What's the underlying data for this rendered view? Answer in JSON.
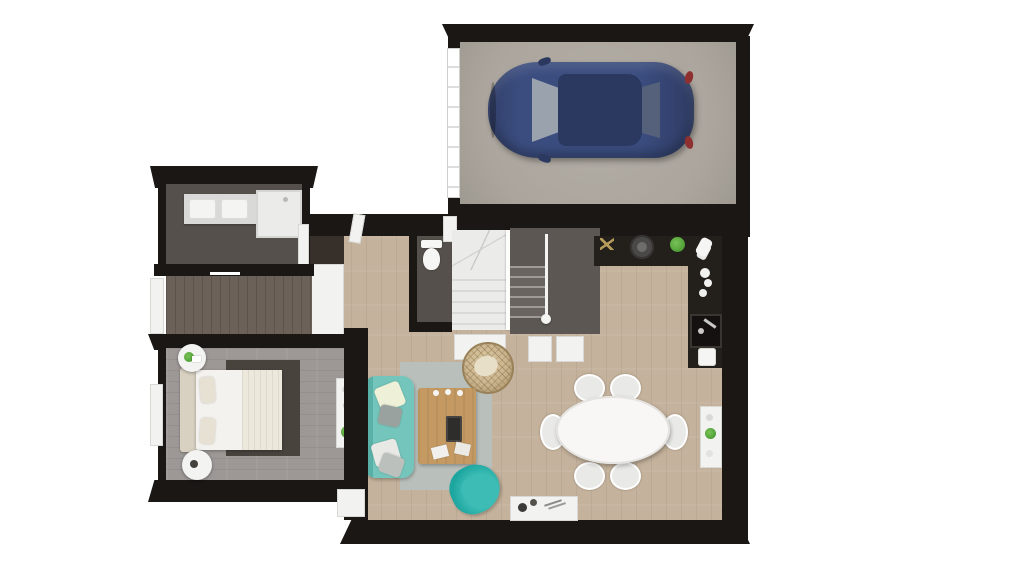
{
  "scene": {
    "type": "3d-floor-plan-top-down",
    "description": "Top-down 3D rendered floor plan of a single-storey home with attached garage, shown on a white background. No text labels are visible in the image."
  },
  "colors": {
    "background": "#ffffff",
    "wall": "#1a1715",
    "garage_floor": "#aba59d",
    "main_floor": "#c4b29c",
    "bedroom_floor": "#9d9896",
    "corridor_floor": "#6b6159",
    "bathroom_floor": "#55504b",
    "dark_zone": "#5c5752",
    "closet_dark": "#362f2a",
    "white_panel": "#f2f2f0",
    "stairs_light": "#ebebe9",
    "stairs_step": "#d9d9d7",
    "counter_dark": "#23201c",
    "sink_dark": "#141110",
    "rug_base": "#b9c0bc",
    "rug_dark": "#17545e",
    "rug_teal": "#2e8b8a",
    "bedroom_rug": "#49433e",
    "bed_white": "#f3f2ef",
    "headboard": "#d8d1c1",
    "pillow": "#e7e1d3",
    "sofa": "#74c6bc",
    "sofa_shade": "#58b0a6",
    "armchair": "#1ca69f",
    "armchair_light": "#3cbcb4",
    "coffee_table": "#c49a62",
    "hanging_chair": "#c9b48e",
    "car_body": "#3b4d7f",
    "car_dark": "#2b3960",
    "car_glass": "#9aa3ad",
    "car_glass_dark": "#55607a",
    "tail_red": "#8f3030",
    "plant": "#55a53b",
    "table_white": "#f8f7f5",
    "chair_gray": "#e9e9e7",
    "gold": "#b59a5a",
    "chrome": "#c9c9c7"
  },
  "rooms": [
    {
      "name": "garage",
      "floor": "concrete-gray"
    },
    {
      "name": "bathroom",
      "floor": "dark-gray",
      "contents": [
        "double-sink-vanity",
        "shower"
      ]
    },
    {
      "name": "hallway",
      "floor": "dark-wood",
      "contents": [
        "sliding-doors",
        "closet"
      ]
    },
    {
      "name": "bedroom",
      "floor": "gray-wood",
      "contents": [
        "double-bed",
        "nightstand-x2",
        "dark-rug",
        "dresser"
      ]
    },
    {
      "name": "wc",
      "floor": "dark-gray",
      "contents": [
        "toilet"
      ]
    },
    {
      "name": "staircase",
      "contents": [
        "winder-stairs",
        "railing",
        "under-stair-closets"
      ]
    },
    {
      "name": "kitchen",
      "contents": [
        "l-shaped-counter",
        "sink",
        "pan",
        "plant",
        "small-appliances"
      ]
    },
    {
      "name": "living-dining",
      "floor": "light-wood",
      "contents": [
        "sofa",
        "armchair",
        "coffee-table",
        "geometric-rug",
        "hanging-rattan-chair",
        "oval-dining-table",
        "dining-chairs-x6",
        "sideboard",
        "low-console"
      ]
    }
  ],
  "furniture": [
    {
      "room": "garage",
      "item": "car",
      "color_ref": "car_body"
    },
    {
      "room": "bathroom",
      "item": "double-sink-vanity"
    },
    {
      "room": "bathroom",
      "item": "shower"
    },
    {
      "room": "wc",
      "item": "toilet"
    },
    {
      "room": "hallway",
      "item": "entry-closet"
    },
    {
      "room": "staircase",
      "item": "stairs-with-landing"
    },
    {
      "room": "kitchen",
      "item": "dark-l-counter"
    },
    {
      "room": "kitchen",
      "item": "sink-with-faucet"
    },
    {
      "room": "living-dining",
      "item": "teal-sofa",
      "color_ref": "sofa"
    },
    {
      "room": "living-dining",
      "item": "teal-armchair",
      "color_ref": "armchair"
    },
    {
      "room": "living-dining",
      "item": "wood-coffee-table",
      "color_ref": "coffee_table"
    },
    {
      "room": "living-dining",
      "item": "triangle-pattern-rug"
    },
    {
      "room": "living-dining",
      "item": "rattan-hanging-chair"
    },
    {
      "room": "living-dining",
      "item": "white-oval-table-six-chairs"
    },
    {
      "room": "living-dining",
      "item": "white-sideboard"
    },
    {
      "room": "living-dining",
      "item": "white-low-console"
    },
    {
      "room": "bedroom",
      "item": "double-bed-white-linen"
    },
    {
      "room": "bedroom",
      "item": "round-nightstands",
      "count": 2
    },
    {
      "room": "bedroom",
      "item": "white-dresser"
    },
    {
      "room": "bedroom",
      "item": "dark-area-rug"
    }
  ]
}
